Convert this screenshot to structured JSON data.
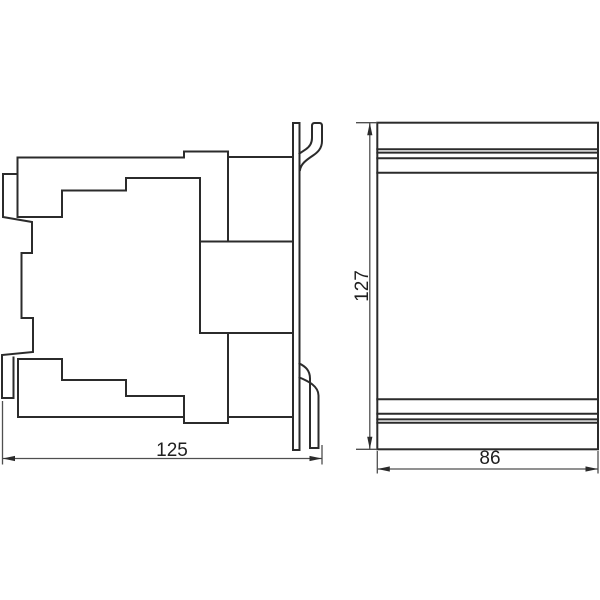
{
  "drawing": {
    "kind": "two-view technical dimension drawing",
    "views": [
      {
        "id": "side-view",
        "description": "side profile of device with DIN-rail mounting plate, top hook and bottom spring clip"
      },
      {
        "id": "front-view",
        "description": "rear/front panel rectangle with horizontal rail bands near top and bottom"
      }
    ]
  },
  "dimensions": {
    "side_view_width": "125",
    "overall_height": "127",
    "front_view_width": "86"
  },
  "colors": {
    "outline": "#2b2b2b",
    "dimension": "#4f4f4f",
    "arrow": "#2b2b2b",
    "text": "#1f1f1f",
    "background": "#ffffff"
  }
}
